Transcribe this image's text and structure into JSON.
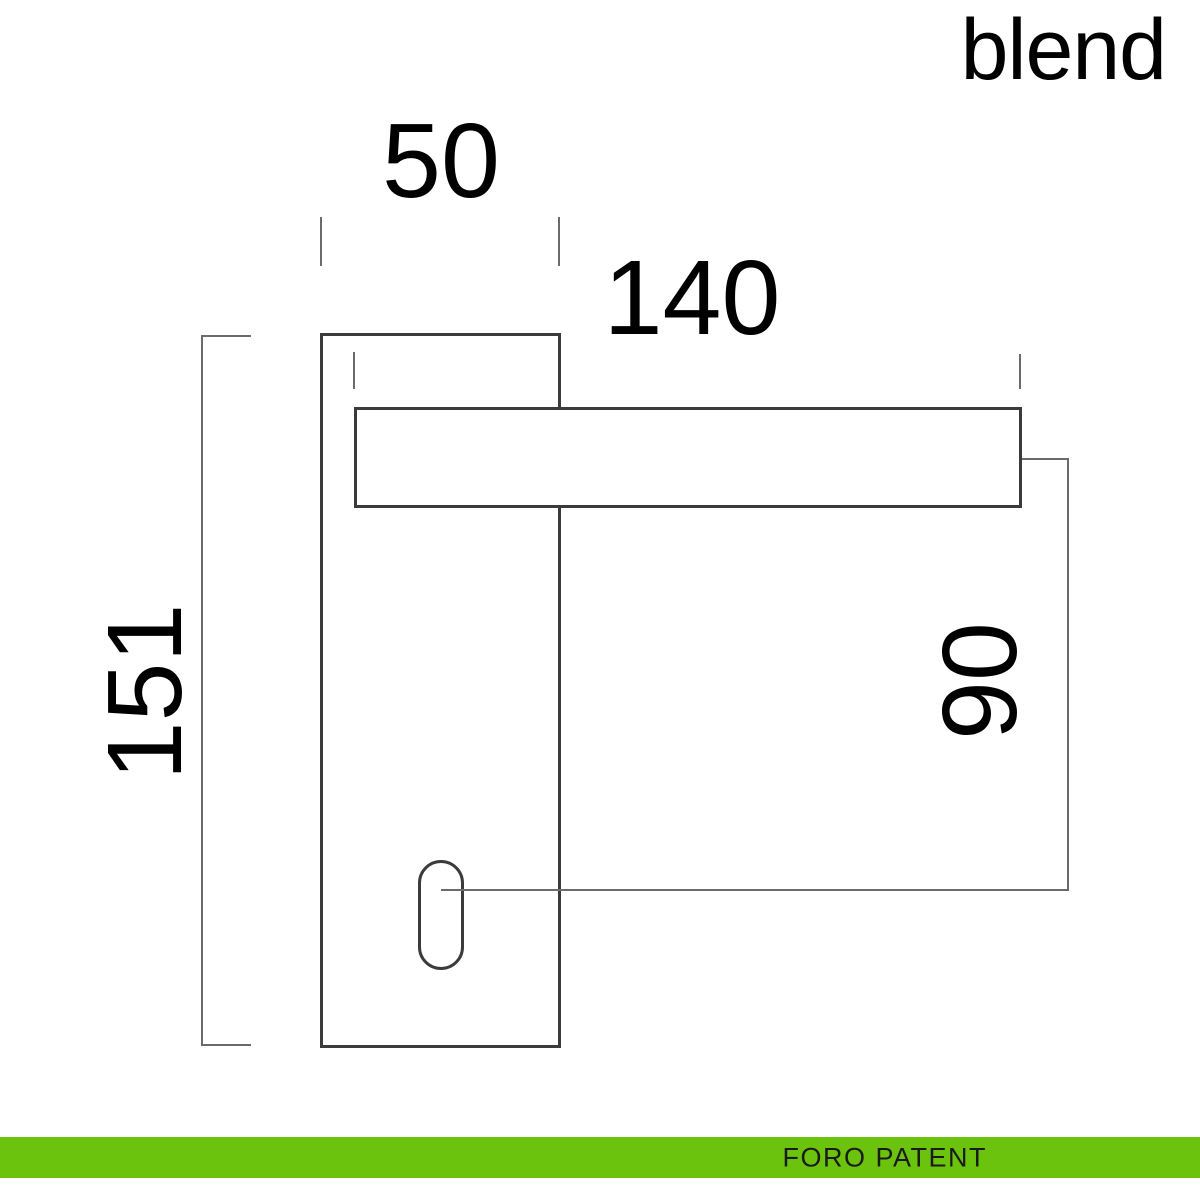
{
  "brand": {
    "logo": "blend"
  },
  "drawing": {
    "type": "door-handle-technical-drawing",
    "labels": {
      "plate_width": "50",
      "handle_length": "140",
      "plate_height": "151",
      "keyhole_distance": "90"
    },
    "colors": {
      "outline": "#3b3b3b",
      "dimension": "#6b6b6b",
      "label_text": "#000000"
    }
  },
  "footer": {
    "label": "FORO PATENT",
    "bar_color": "#6cc30d",
    "text_color": "#1a1a1a"
  }
}
